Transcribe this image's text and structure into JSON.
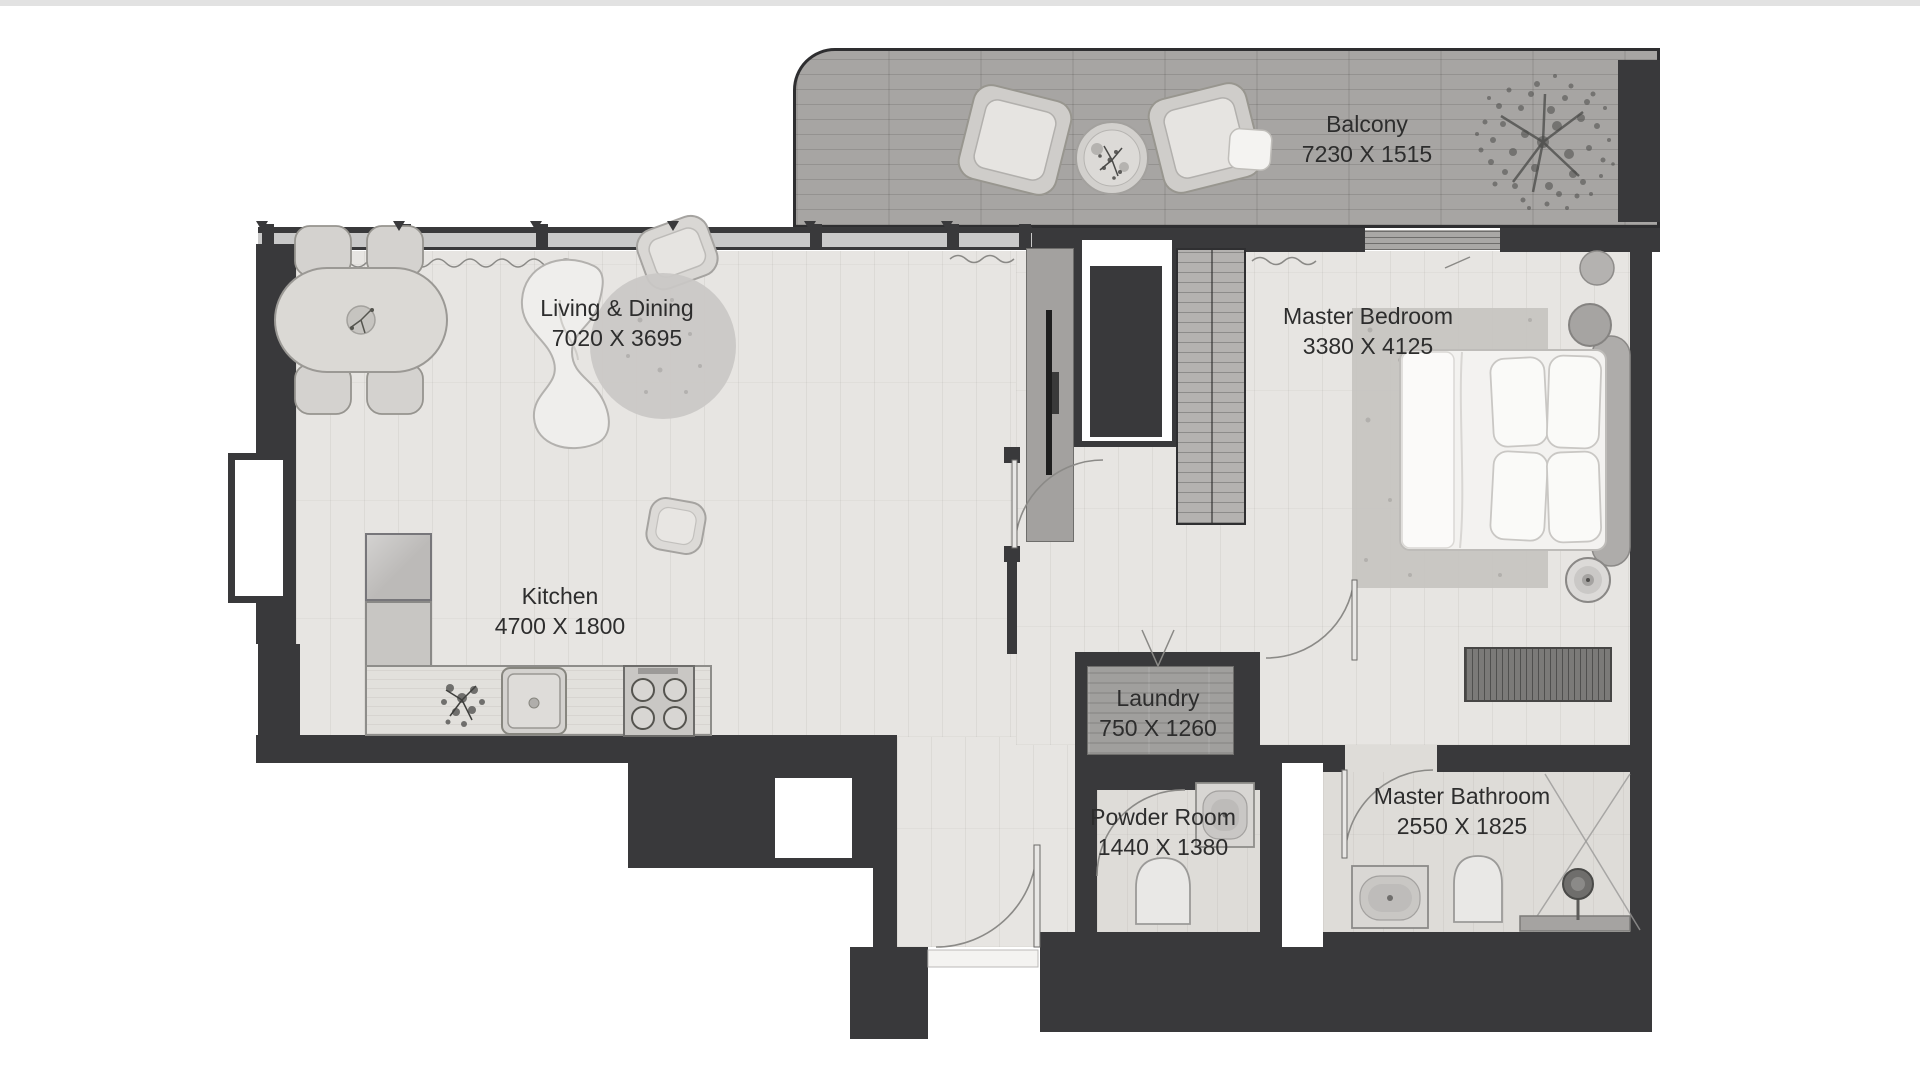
{
  "plan": {
    "rooms": [
      {
        "name": "Balcony",
        "dimensions": "7230 X 1515"
      },
      {
        "name": "Living & Dining",
        "dimensions": "7020 X 3695"
      },
      {
        "name": "Master Bedroom",
        "dimensions": "3380 X 4125"
      },
      {
        "name": "Kitchen",
        "dimensions": "4700 X 1800"
      },
      {
        "name": "Laundry",
        "dimensions": "750 X 1260"
      },
      {
        "name": "Powder Room",
        "dimensions": "1440 X 1380"
      },
      {
        "name": "Master Bathroom",
        "dimensions": "2550 X 1825"
      }
    ],
    "colors": {
      "wall": "#39393b",
      "floor": "#e7e5e2",
      "balcony_floor": "#a7a5a3",
      "window_band": "#c9c9c9",
      "text": "#2d2d2d"
    },
    "furniture_icons": [
      "dining-table-icon",
      "dining-chair-icon",
      "curved-sofa-icon",
      "armchair-icon",
      "round-rug-icon",
      "pouf-icon",
      "kitchen-sink-icon",
      "stove-icon",
      "plant-icon",
      "fridge-cabinet-icon",
      "tv-panel-icon",
      "wardrobe-icon",
      "double-bed-icon",
      "pillow-icon",
      "bedside-table-icon",
      "speaker-icon",
      "bench-icon",
      "washbasin-icon",
      "toilet-icon",
      "shower-icon",
      "balcony-chair-icon",
      "coffee-table-icon",
      "tree-icon",
      "door-swing-icon",
      "curtain-icon"
    ]
  }
}
